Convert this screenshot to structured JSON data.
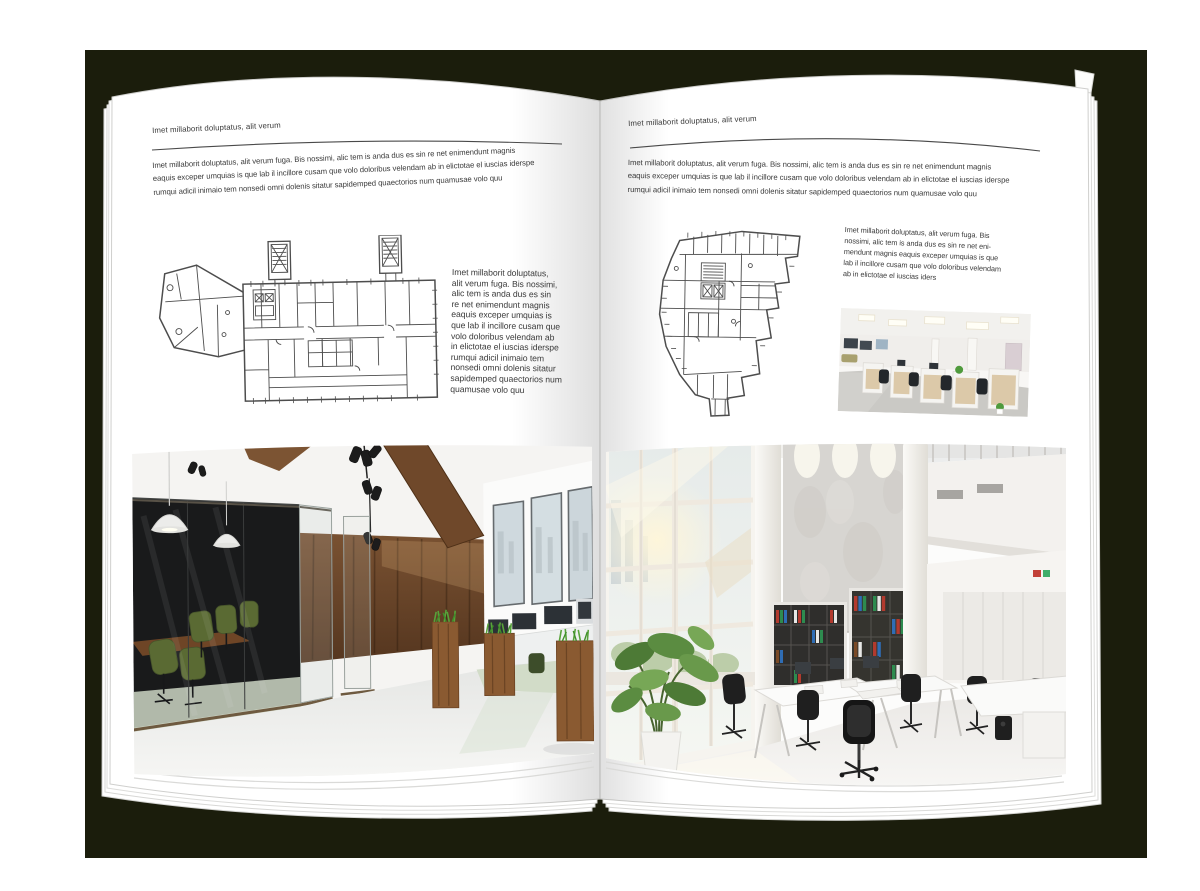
{
  "colors": {
    "backdrop": "#1b1d0c",
    "page": "#ffffff",
    "text": "#3a3a3a",
    "rule": "#4a4a4a",
    "plan_line": "#4d4d4d",
    "wood": "#6e4a2b",
    "grass": "#58a33a",
    "dark_glass": "#17181a",
    "concrete": "#d7d5d1",
    "floor_light": "#efeeec"
  },
  "left_page": {
    "header": "Imet millaborit doluptatus, alit verum",
    "intro": "Imet millaborit doluptatus, alit verum fuga. Bis nossimi, alic tem is anda dus es sin re net enimendunt magnis\neaquis exceper umquias is que lab il incillore cusam que volo doloribus velendam ab in elictotae el iuscias iderspe\nrumqui adicil inimaio tem nonsedi omni dolenis sitatur sapidemped quaectorios num quamusae volo quu",
    "caption": "Imet millaborit doluptatus,\nalit verum fuga. Bis nossimi,\nalic tem is anda dus es sin\nre net enimendunt magnis\neaquis exceper umquias is\nque lab il incillore cusam que\nvolo doloribus velendam ab\nin elictotae el iuscias iderspe\nrumqui adicil inimaio tem\nnonsedi omni dolenis sitatur\nsapidemped quaectorios num\nquamusae volo quu",
    "floor_plan": "office-building-floor-plan-wide",
    "photo": "dark-loft-office-interior-photo"
  },
  "right_page": {
    "header": "Imet millaborit doluptatus, alit verum",
    "intro": "Imet millaborit doluptatus, alit verum fuga. Bis nossimi, alic tem is anda dus es sin re net enimendunt magnis\neaquis exceper umquias is que lab il incillore cusam que volo doloribus velendam ab in elictotae el iuscias iderspe\nrumqui adicil inimaio tem nonsedi omni dolenis sitatur sapidemped quaectorios num quamusae volo quu",
    "caption": "Imet millaborit doluptatus, alit verum fuga. Bis\nnossimi, alic tem is anda dus es sin re net eni-\nmendunt magnis eaquis exceper umquias is que\nlab il incillore cusam que volo doloribus velendam\nab in elictotae el iuscias iders",
    "floor_plan": "office-building-floor-plan-irregular",
    "photo_small": "white-cubicle-office-photo",
    "photo": "bright-atrium-office-photo"
  }
}
